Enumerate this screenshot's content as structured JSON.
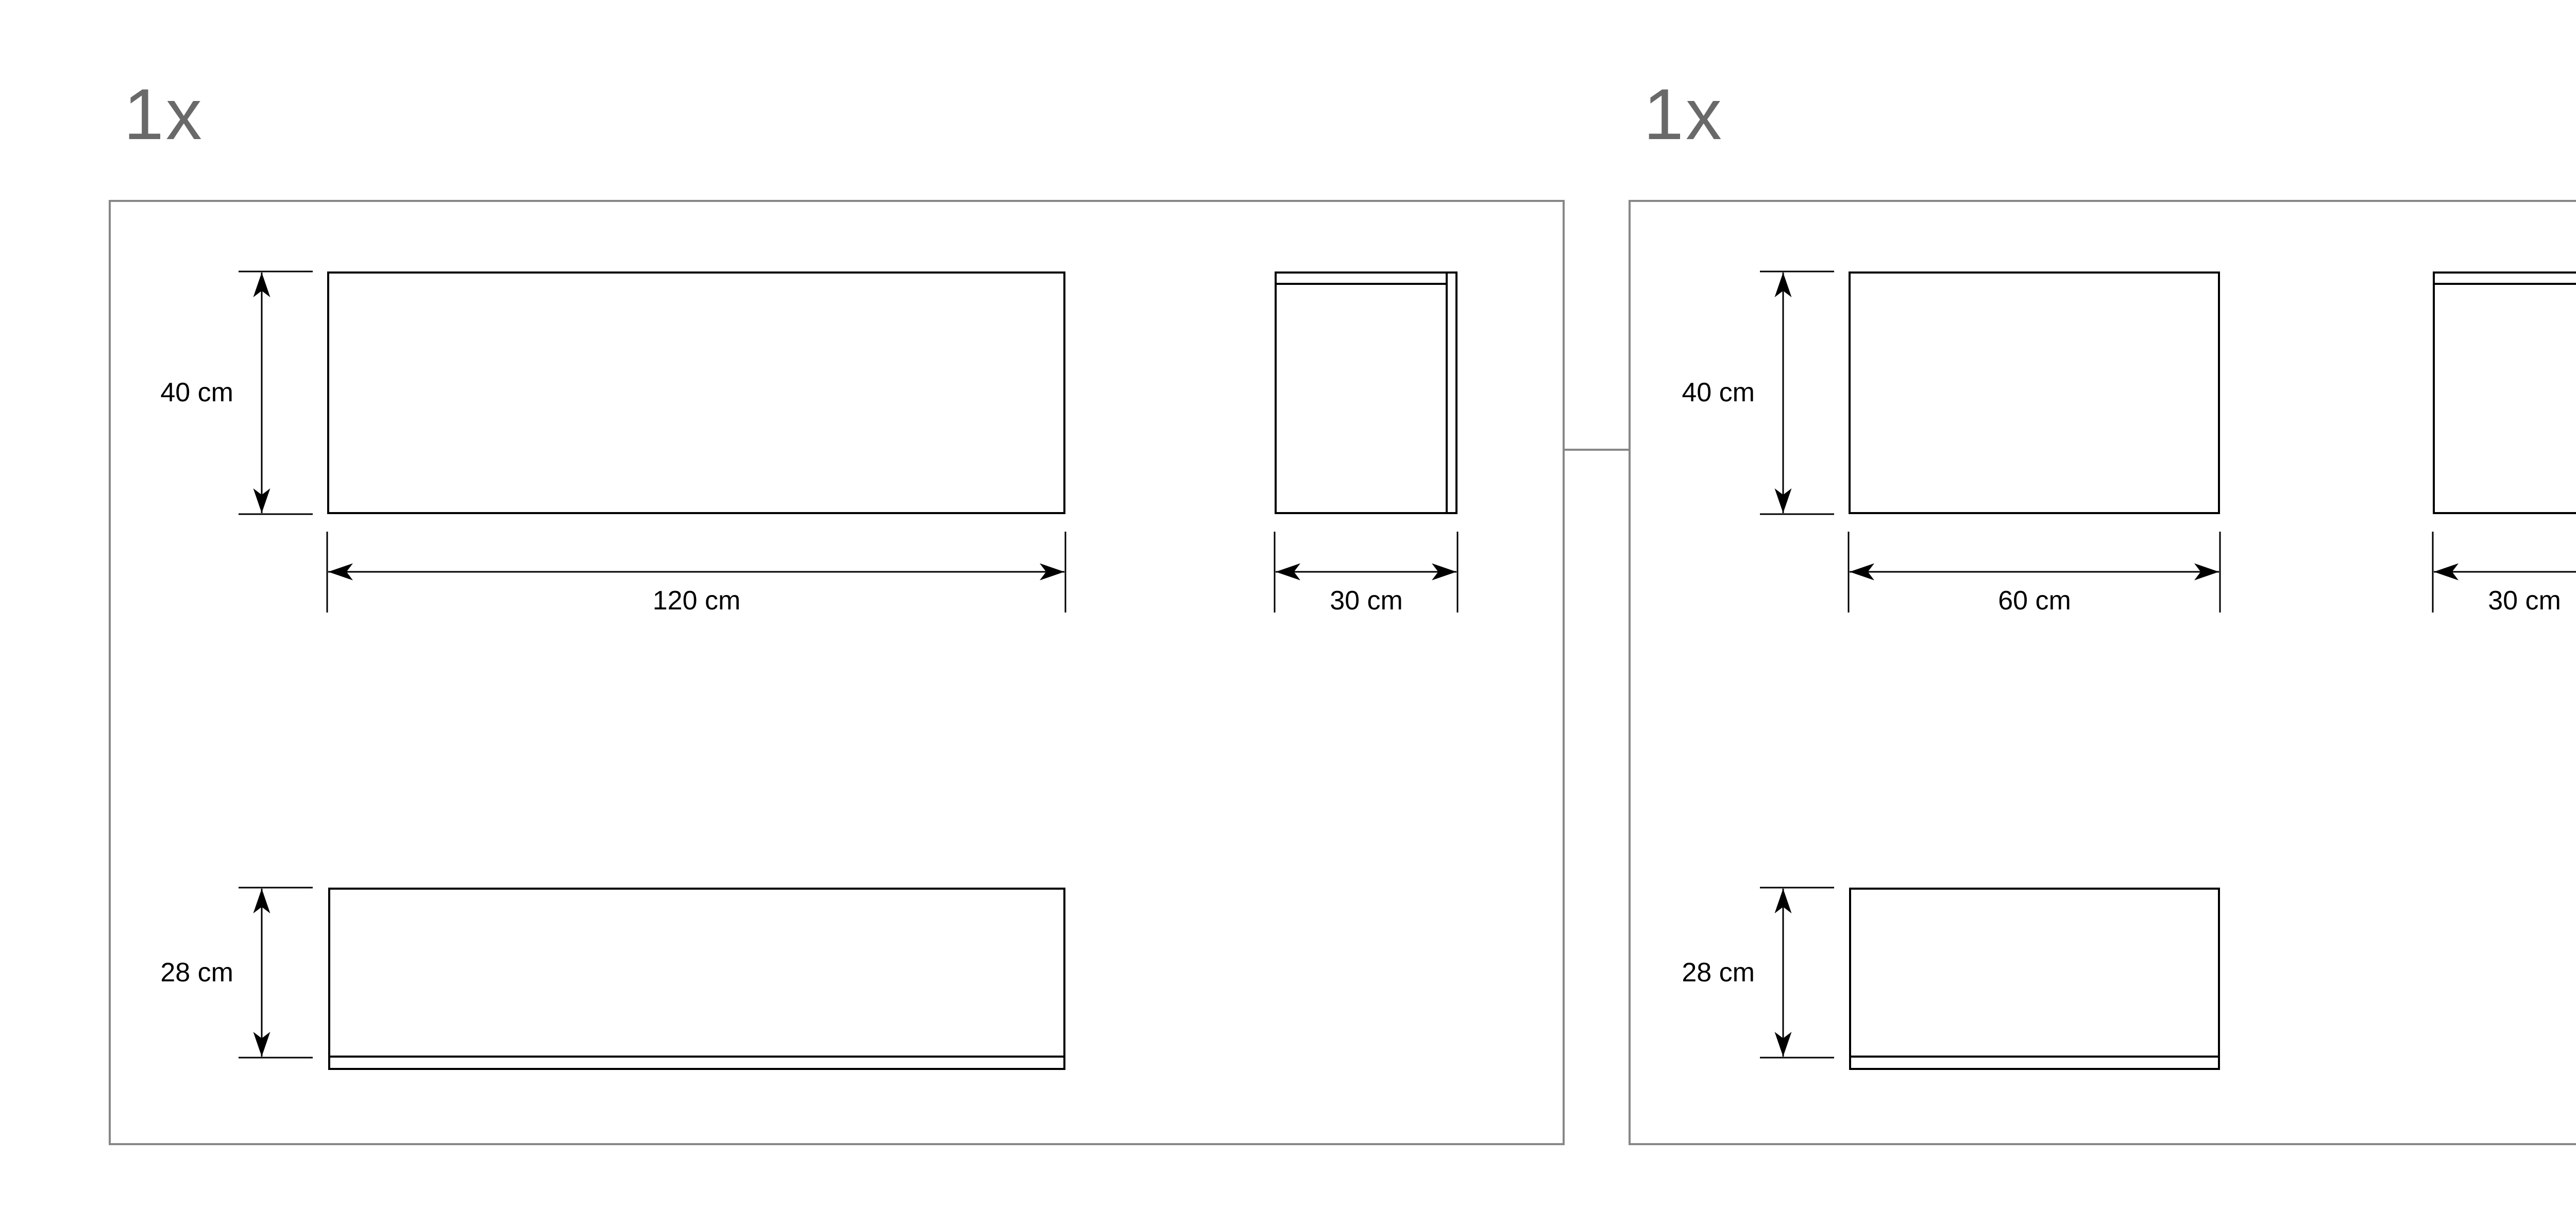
{
  "colors": {
    "line": "#000000",
    "panel_border": "#878787",
    "quantity_text": "#696969"
  },
  "panels": [
    {
      "quantity": "1x",
      "front": {
        "height": "40 cm",
        "width": "120 cm"
      },
      "side": {
        "width": "30 cm"
      },
      "plinth": {
        "height": "28 cm"
      }
    },
    {
      "quantity": "1x",
      "front": {
        "height": "40 cm",
        "width": "60 cm"
      },
      "side": {
        "width": "30 cm"
      },
      "plinth": {
        "height": "28 cm"
      }
    }
  ]
}
